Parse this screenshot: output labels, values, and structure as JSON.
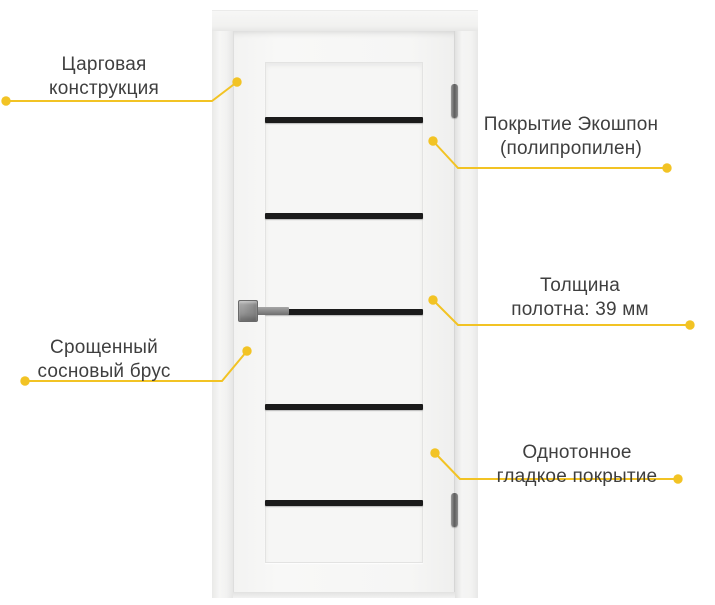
{
  "accent_color": "#F2C324",
  "text_color": "#3F3F3F",
  "door": {
    "stripe_color": "#1B1B1B",
    "stripe_count": 5,
    "hardware": [
      "lock-plate",
      "hinge-top",
      "hinge-bottom"
    ]
  },
  "annotations": {
    "frame_construction": {
      "line1": "Царговая",
      "line2": "конструкция"
    },
    "coating": {
      "line1": "Покрытие Экошпон",
      "line2": "(полипропилен)"
    },
    "thickness": {
      "line1": "Толщина",
      "line2": "полотна: 39 мм"
    },
    "timber": {
      "line1": "Срощенный",
      "line2": "сосновый брус"
    },
    "surface": {
      "line1": "Однотонное",
      "line2": "гладкое покрытие"
    }
  }
}
